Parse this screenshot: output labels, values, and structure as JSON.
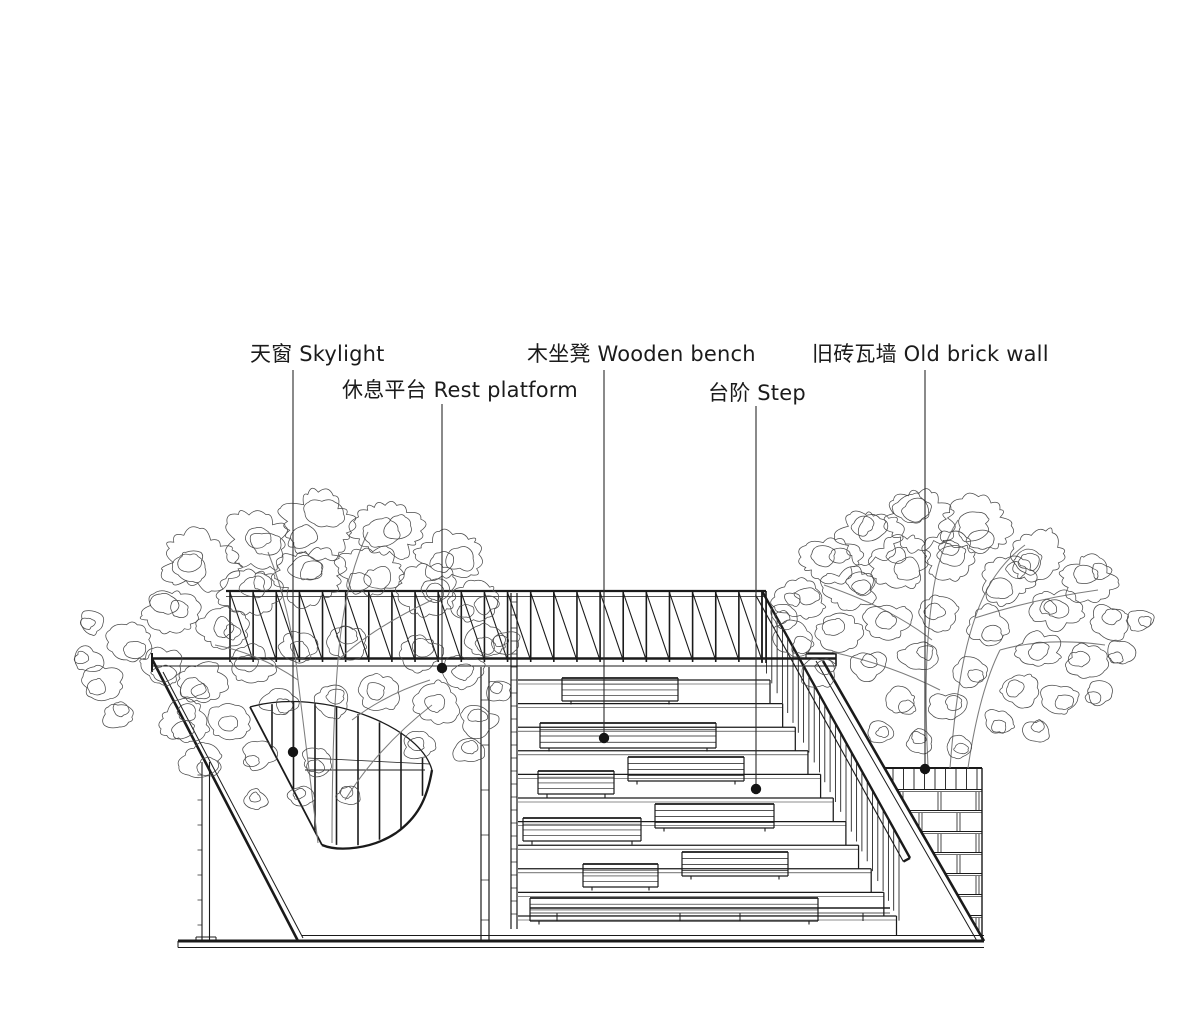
{
  "page": {
    "type": "architectural-section-diagram",
    "background": "#ffffff"
  },
  "colors": {
    "line": "#1a1a1a",
    "foliage": "#4a4a4a",
    "trunk": "#7d7d7d",
    "leader": "#2b2b2b",
    "dot": "#141414",
    "text": "#1b1b1b"
  },
  "labels": {
    "skylight": {
      "zh": "天窗",
      "en": "Skylight"
    },
    "rest_platform": {
      "zh": "休息平台",
      "en": "Rest platform"
    },
    "wooden_bench": {
      "zh": "木坐凳",
      "en": "Wooden bench"
    },
    "step": {
      "zh": "台阶",
      "en": "Step"
    },
    "old_brick_wall": {
      "zh": "旧砖瓦墙",
      "en": "Old brick wall"
    }
  },
  "callouts": [
    {
      "id": "skylight",
      "label": "天窗 Skylight",
      "label_x": 250,
      "label_y": 341,
      "line_x": 293,
      "line_y1": 370,
      "dot_x": 293,
      "dot_y": 752
    },
    {
      "id": "rest-platform",
      "label": "休息平台 Rest platform",
      "label_x": 342,
      "label_y": 377,
      "line_x": 442,
      "line_y1": 404,
      "dot_x": 442,
      "dot_y": 668
    },
    {
      "id": "wooden-bench",
      "label": "木坐凳 Wooden bench",
      "label_x": 527,
      "label_y": 341,
      "line_x": 604,
      "line_y1": 370,
      "dot_x": 604,
      "dot_y": 738
    },
    {
      "id": "step",
      "label": "台阶 Step",
      "label_x": 708,
      "label_y": 380,
      "line_x": 756,
      "line_y1": 406,
      "dot_x": 756,
      "dot_y": 789
    },
    {
      "id": "old-brick-wall",
      "label": "旧砖瓦墙 Old brick wall",
      "label_x": 812,
      "label_y": 341,
      "line_x": 925,
      "line_y1": 370,
      "dot_x": 925,
      "dot_y": 769
    }
  ]
}
